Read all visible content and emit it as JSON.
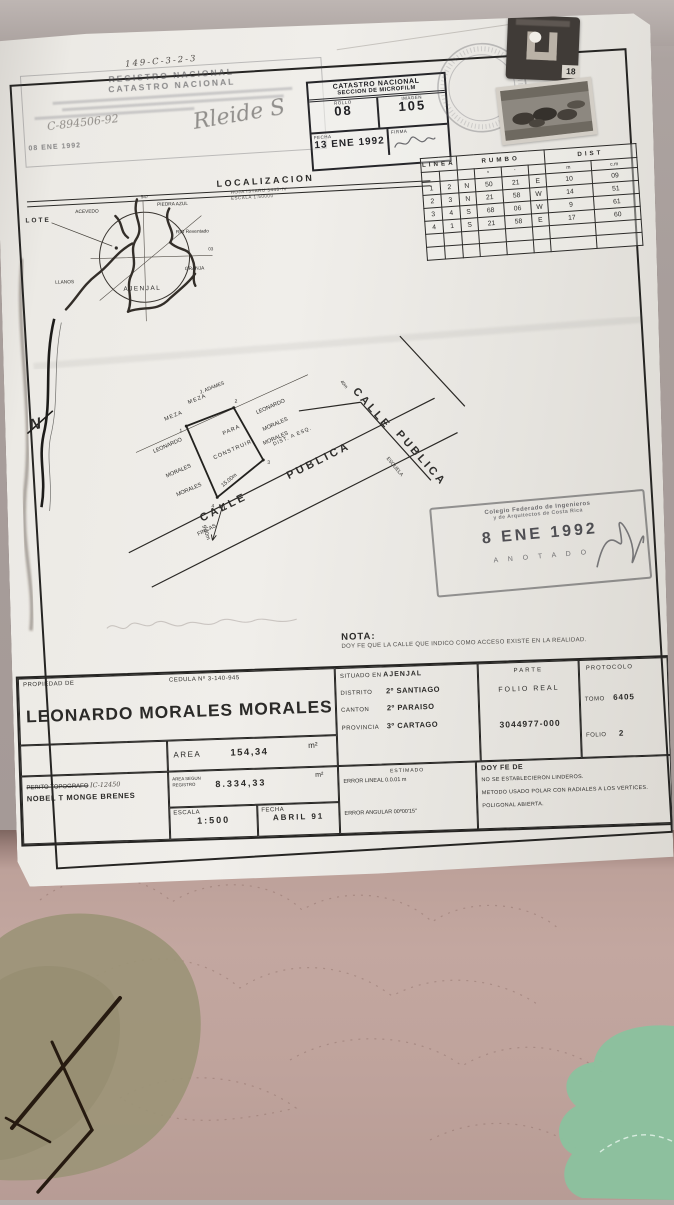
{
  "colors": {
    "paper": "#efede9",
    "ink": "#2b2a28",
    "fabric_pink": "#c3a7a0",
    "fabric_olive": "#9b9377",
    "fabric_mint": "#8ac29e",
    "stamp_ink": "#35353b"
  },
  "meta": {
    "handwritten_corner_number": "29462",
    "file_number": "149-C-3-2-3"
  },
  "registry_stamp": {
    "title1": "REGISTRO NACIONAL",
    "title2": "CATASTRO NACIONAL",
    "handwritten_number": "C-894506-92",
    "date": "08 ENE 1992",
    "signature": "Rleide S"
  },
  "microfilm_box": {
    "title1": "CATASTRO NACIONAL",
    "title2": "SECCION DE MICROFILM",
    "rollo_label": "ROLLO",
    "rollo": "08",
    "imagen_label": "IMAGEN",
    "imagen": "105",
    "fecha_label": "FECHA",
    "fecha": "13 ENE 1992",
    "firma_label": "FIRMA"
  },
  "revenue_stamp_value": "18",
  "bearings_table": {
    "col_linea": "LINEA",
    "col_rumbo": "RUMBO",
    "col_dist": "DIST",
    "deg_mark": "º",
    "min_mark": "'",
    "m_label": "m",
    "cm_label": "c.m",
    "rows": [
      [
        "1",
        "2",
        "N",
        "50",
        "21",
        "E",
        "10",
        "09"
      ],
      [
        "2",
        "3",
        "N",
        "21",
        "58",
        "W",
        "14",
        "51"
      ],
      [
        "3",
        "4",
        "S",
        "68",
        "06",
        "W",
        "9",
        "61"
      ],
      [
        "4",
        "1",
        "S",
        "21",
        "58",
        "E",
        "17",
        "60"
      ]
    ]
  },
  "localization": {
    "title": "LOCALIZACION",
    "sheet_line": "HOJA ISTARU 3445-IV",
    "scale_line": "ESCALA 1:50000",
    "lote": "LOTE",
    "grid_n": "547",
    "acevedo": "ACEVEDO",
    "piedra_azul": "PIEDRA AZUL",
    "rio": "RIO  Reventado",
    "coord": "03",
    "granja": "GRANJA",
    "llanos": "LLANOS",
    "ajenjal": "AJENJAL"
  },
  "north_label": "N",
  "site_plan": {
    "calle": "CALLE",
    "publica": "PUBLICA",
    "fincas": "FINCAS",
    "escuela": "ESCUELA",
    "dist_esq": "DIST.  A  ESQ.",
    "dist_val": "40m",
    "dim_side": "15.00m",
    "dim_road": "9.00m",
    "adames": "J. ADAMES",
    "meza1": "MEZA",
    "meza2": "MEZA",
    "owner_l1": "LEONARDO",
    "owner_l2": "MORALES",
    "owner_l3": "MORALES",
    "owner_r1": "LEONARDO",
    "owner_r2": "MORALES",
    "owner_r3": "MORALES",
    "para": "PARA",
    "construir": "CONSTRUIR",
    "v1": "1",
    "v2": "2",
    "v3": "3",
    "v4": "4"
  },
  "cfia_stamp": {
    "line1": "Colegio  Federado  de  Ingenieros",
    "line2": "y  de  Arquitectos  de  Costa  Rica",
    "date": "8  ENE 1992",
    "anotado": "A N O T A D O"
  },
  "nota": {
    "label": "NOTA:",
    "text": "DOY FE QUE LA CALLE QUE INDICO COMO ACCESO EXISTE EN LA REALIDAD."
  },
  "info": {
    "propiedad_label": "PROPIEDAD DE",
    "cedula": "CEDULA Nº 3-140-945",
    "owner": "LEONARDO MORALES MORALES",
    "situado_label": "SITUADO EN",
    "situado": "AJENJAL",
    "distrito_label": "DISTRITO",
    "distrito": "2º SANTIAGO",
    "canton_label": "CANTON",
    "canton": "2º PARAISO",
    "provincia_label": "PROVINCIA",
    "provincia": "3º CARTAGO",
    "parte_label": "PARTE",
    "folio_real_label": "FOLIO REAL",
    "folio_real": "3044977-000",
    "protocolo_label": "PROTOCOLO",
    "tomo_label": "TOMO",
    "tomo": "6405",
    "folio_label": "FOLIO",
    "folio": "2",
    "area_label": "AREA",
    "area": "154,34",
    "m2": "m²",
    "perito_label": "PERITO TOPOGRAFO",
    "perito_num": "IC-12450",
    "perito_name": "NOBEL T MONGE BRENES",
    "area_reg_label1": "AREA  SEGUN",
    "area_reg_label2": "REGISTRO",
    "area_reg": "8.334,33",
    "escala_label": "ESCALA",
    "escala": "1:500",
    "fecha_label": "FECHA",
    "fecha": "ABRIL 91",
    "estimado_label": "ESTIMADO",
    "err1": "ERROR LINEAL  0.0.01   m",
    "err2": "ERROR ANGULAR 00º00'15\"",
    "doyfe": "DOY FE DE",
    "fe1": "NO SE ESTABLECIERON LINDEROS.",
    "fe2": "METODO USADO POLAR CON RADIALES A LOS VERTICES.",
    "fe3": "POLIGONAL ABIERTA."
  }
}
